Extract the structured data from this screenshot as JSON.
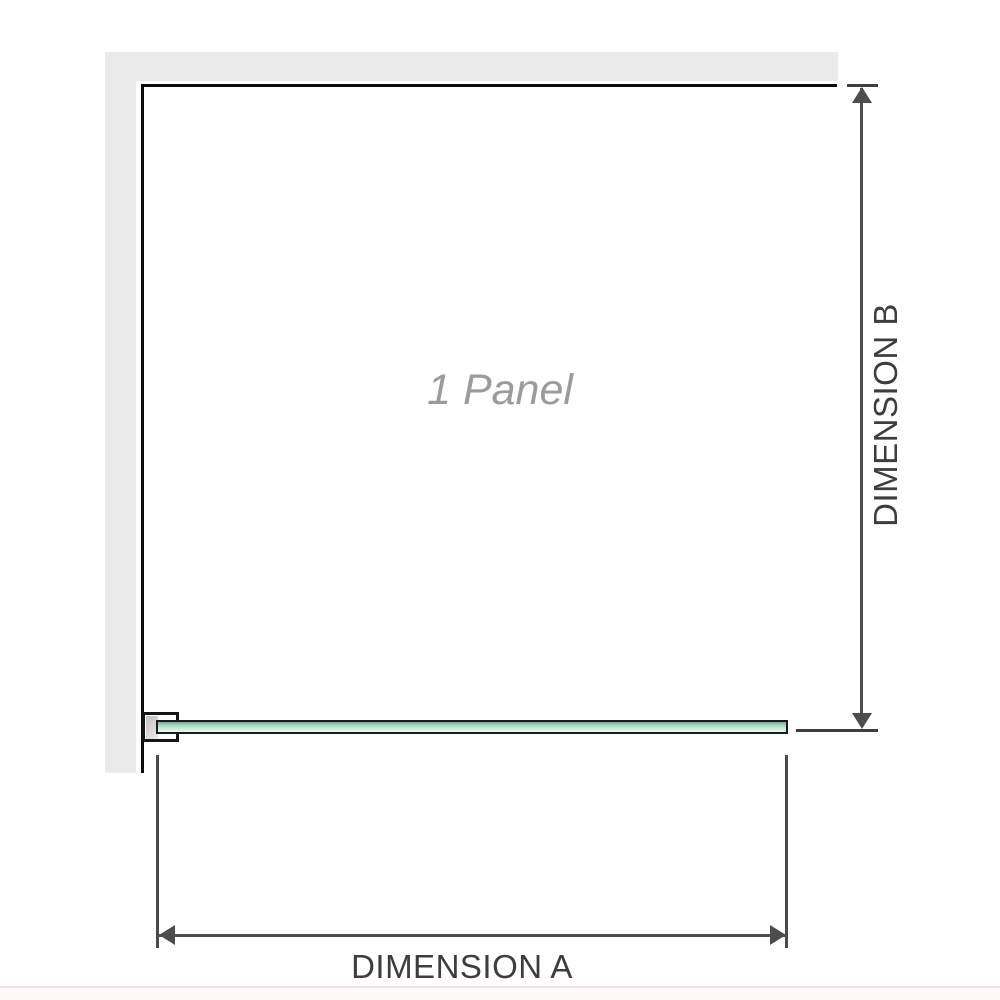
{
  "diagram": {
    "panel_label": "1 Panel",
    "dimension_a": {
      "label": "DIMENSION A"
    },
    "dimension_b": {
      "label": "DIMENSION B"
    },
    "colors": {
      "wall_gray": "#eaeaea",
      "panel_edge_black": "#0d0d0d",
      "glass_green_top": "#6fae8e",
      "glass_green_mid": "#a9dbc0",
      "glass_green_light": "#edf8f2",
      "dimension_line_gray": "#4d4d4d",
      "label_text_gray": "#3d3d3d",
      "panel_label_gray": "#9b9b9b",
      "bracket_pad_gray": "#c0c0c0"
    }
  }
}
